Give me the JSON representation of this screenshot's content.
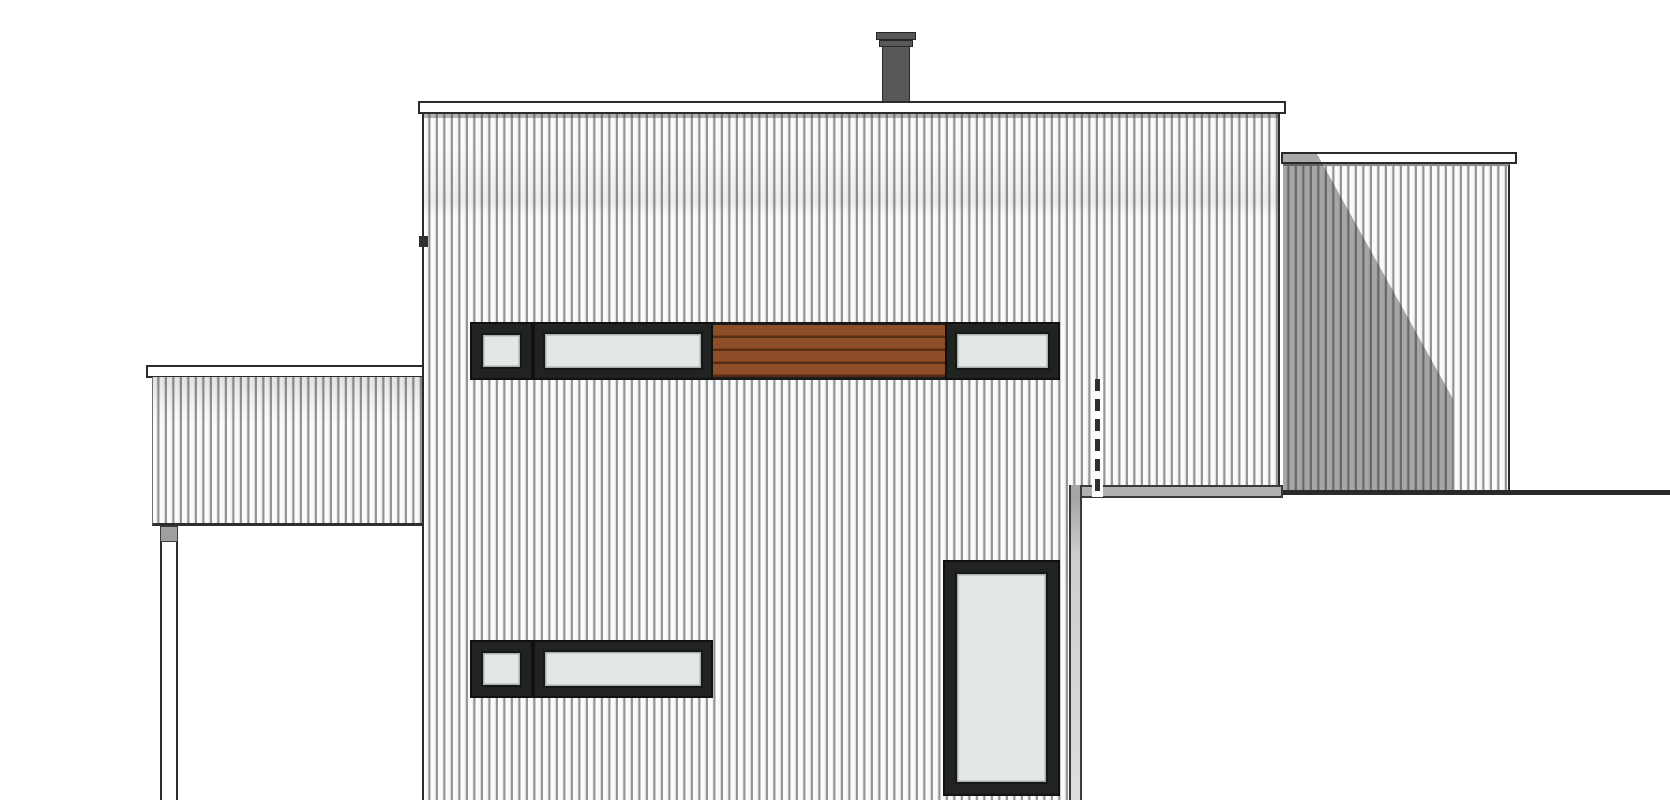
{
  "meta": {
    "type": "architectural-drawing",
    "view": "side-elevation",
    "canvas": {
      "width": 1670,
      "height": 800
    },
    "text_content": "none"
  },
  "colors": {
    "wall-bg": "#fbfbfb",
    "siding-line": "#929292",
    "fascia": "#ffffff",
    "outline": "#2b2b2b",
    "frame": "#212323",
    "glass": "#e3e8e4",
    "wood": "#8d4e27",
    "wood-line": "rgba(56,27,10,0.65)",
    "chimney": "#58585b",
    "shadow": "rgba(40,40,40,0.40)",
    "box-band": "#b0b0b0"
  },
  "elements": {
    "main_volume": {
      "label": "two-storey main volume with vertical siding, flat roof fascia"
    },
    "chimney": {
      "label": "dark grey flue with double cap rings"
    },
    "upper_window_band": {
      "label": "small square window, long ribbon window, wood slat infill, right ribbon window"
    },
    "lower_window_band": {
      "label": "small square window and long ribbon window"
    },
    "tall_door": {
      "label": "full-height glazed door/window at lower right of main wall"
    },
    "dashed_line": {
      "label": "dashed hidden-edge reference line"
    },
    "left_annex": {
      "label": "carport roof with fascia, clad beam and slender post"
    },
    "right_volume": {
      "label": "rear single-storey volume with cast diagonal shadow"
    },
    "foreground_box": {
      "label": "foreground flat roof plane with grey edge band"
    }
  }
}
